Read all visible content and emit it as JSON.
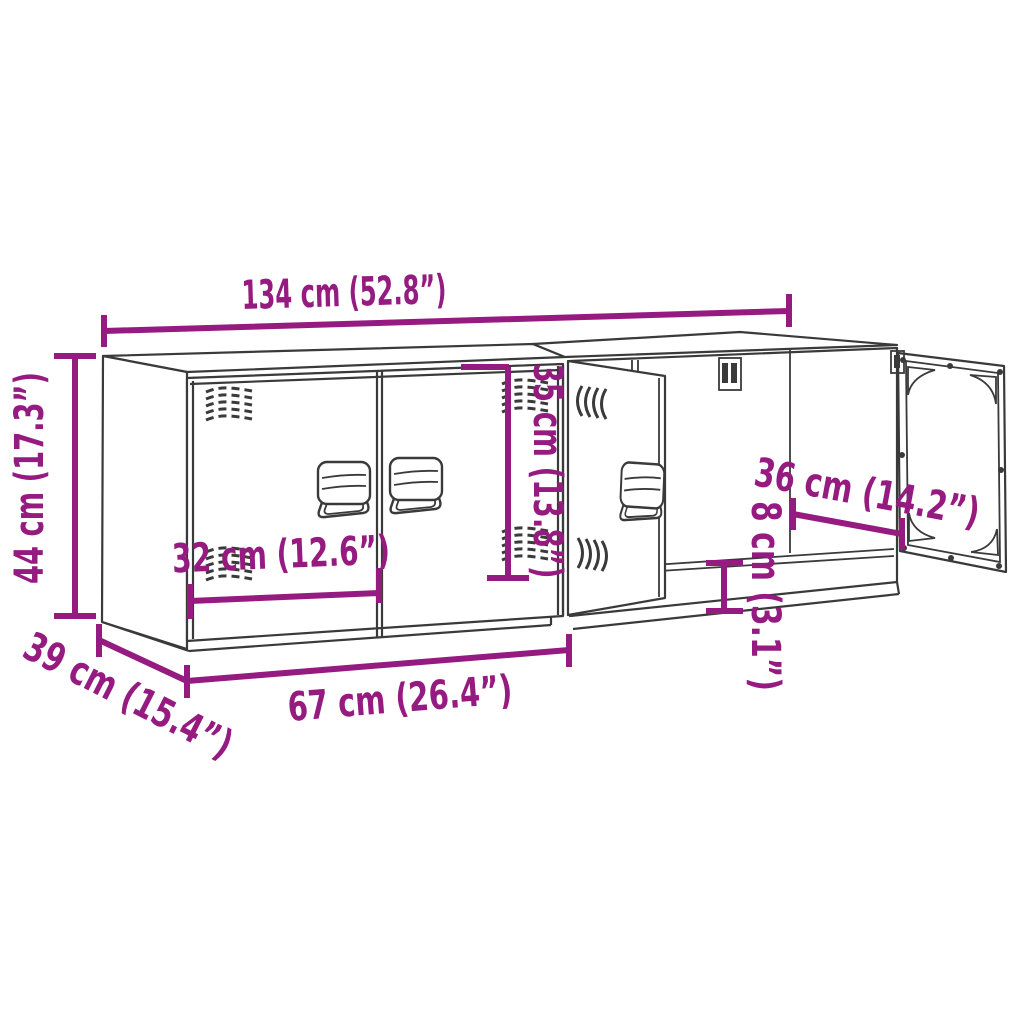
{
  "diagram": {
    "title": "TV cabinet dimension diagram",
    "annotation_color": "#951B81",
    "drawing_color": "#3a3a3a",
    "background": "#ffffff",
    "dimensions": {
      "total_width": {
        "cm": "134",
        "inches": "52.8",
        "label": "134 cm (52.8”)"
      },
      "height": {
        "cm": "44",
        "inches": "17.3",
        "label": "44 cm (17.3”)"
      },
      "depth": {
        "cm": "39",
        "inches": "15.4",
        "label": "39 cm (15.4”)"
      },
      "unit_width": {
        "cm": "67",
        "inches": "26.4",
        "label": "67 cm (26.4”)"
      },
      "door_width": {
        "cm": "32",
        "inches": "12.6",
        "label": "32 cm (12.6”)"
      },
      "door_height": {
        "cm": "35",
        "inches": "13.8",
        "label": "35 cm (13.8”)"
      },
      "inner_width": {
        "cm": "36",
        "inches": "14.2",
        "label": "36 cm (14.2”)"
      },
      "plinth_height": {
        "cm": "8",
        "inches": "3.1",
        "label": "8 cm (3.1”)"
      }
    }
  }
}
